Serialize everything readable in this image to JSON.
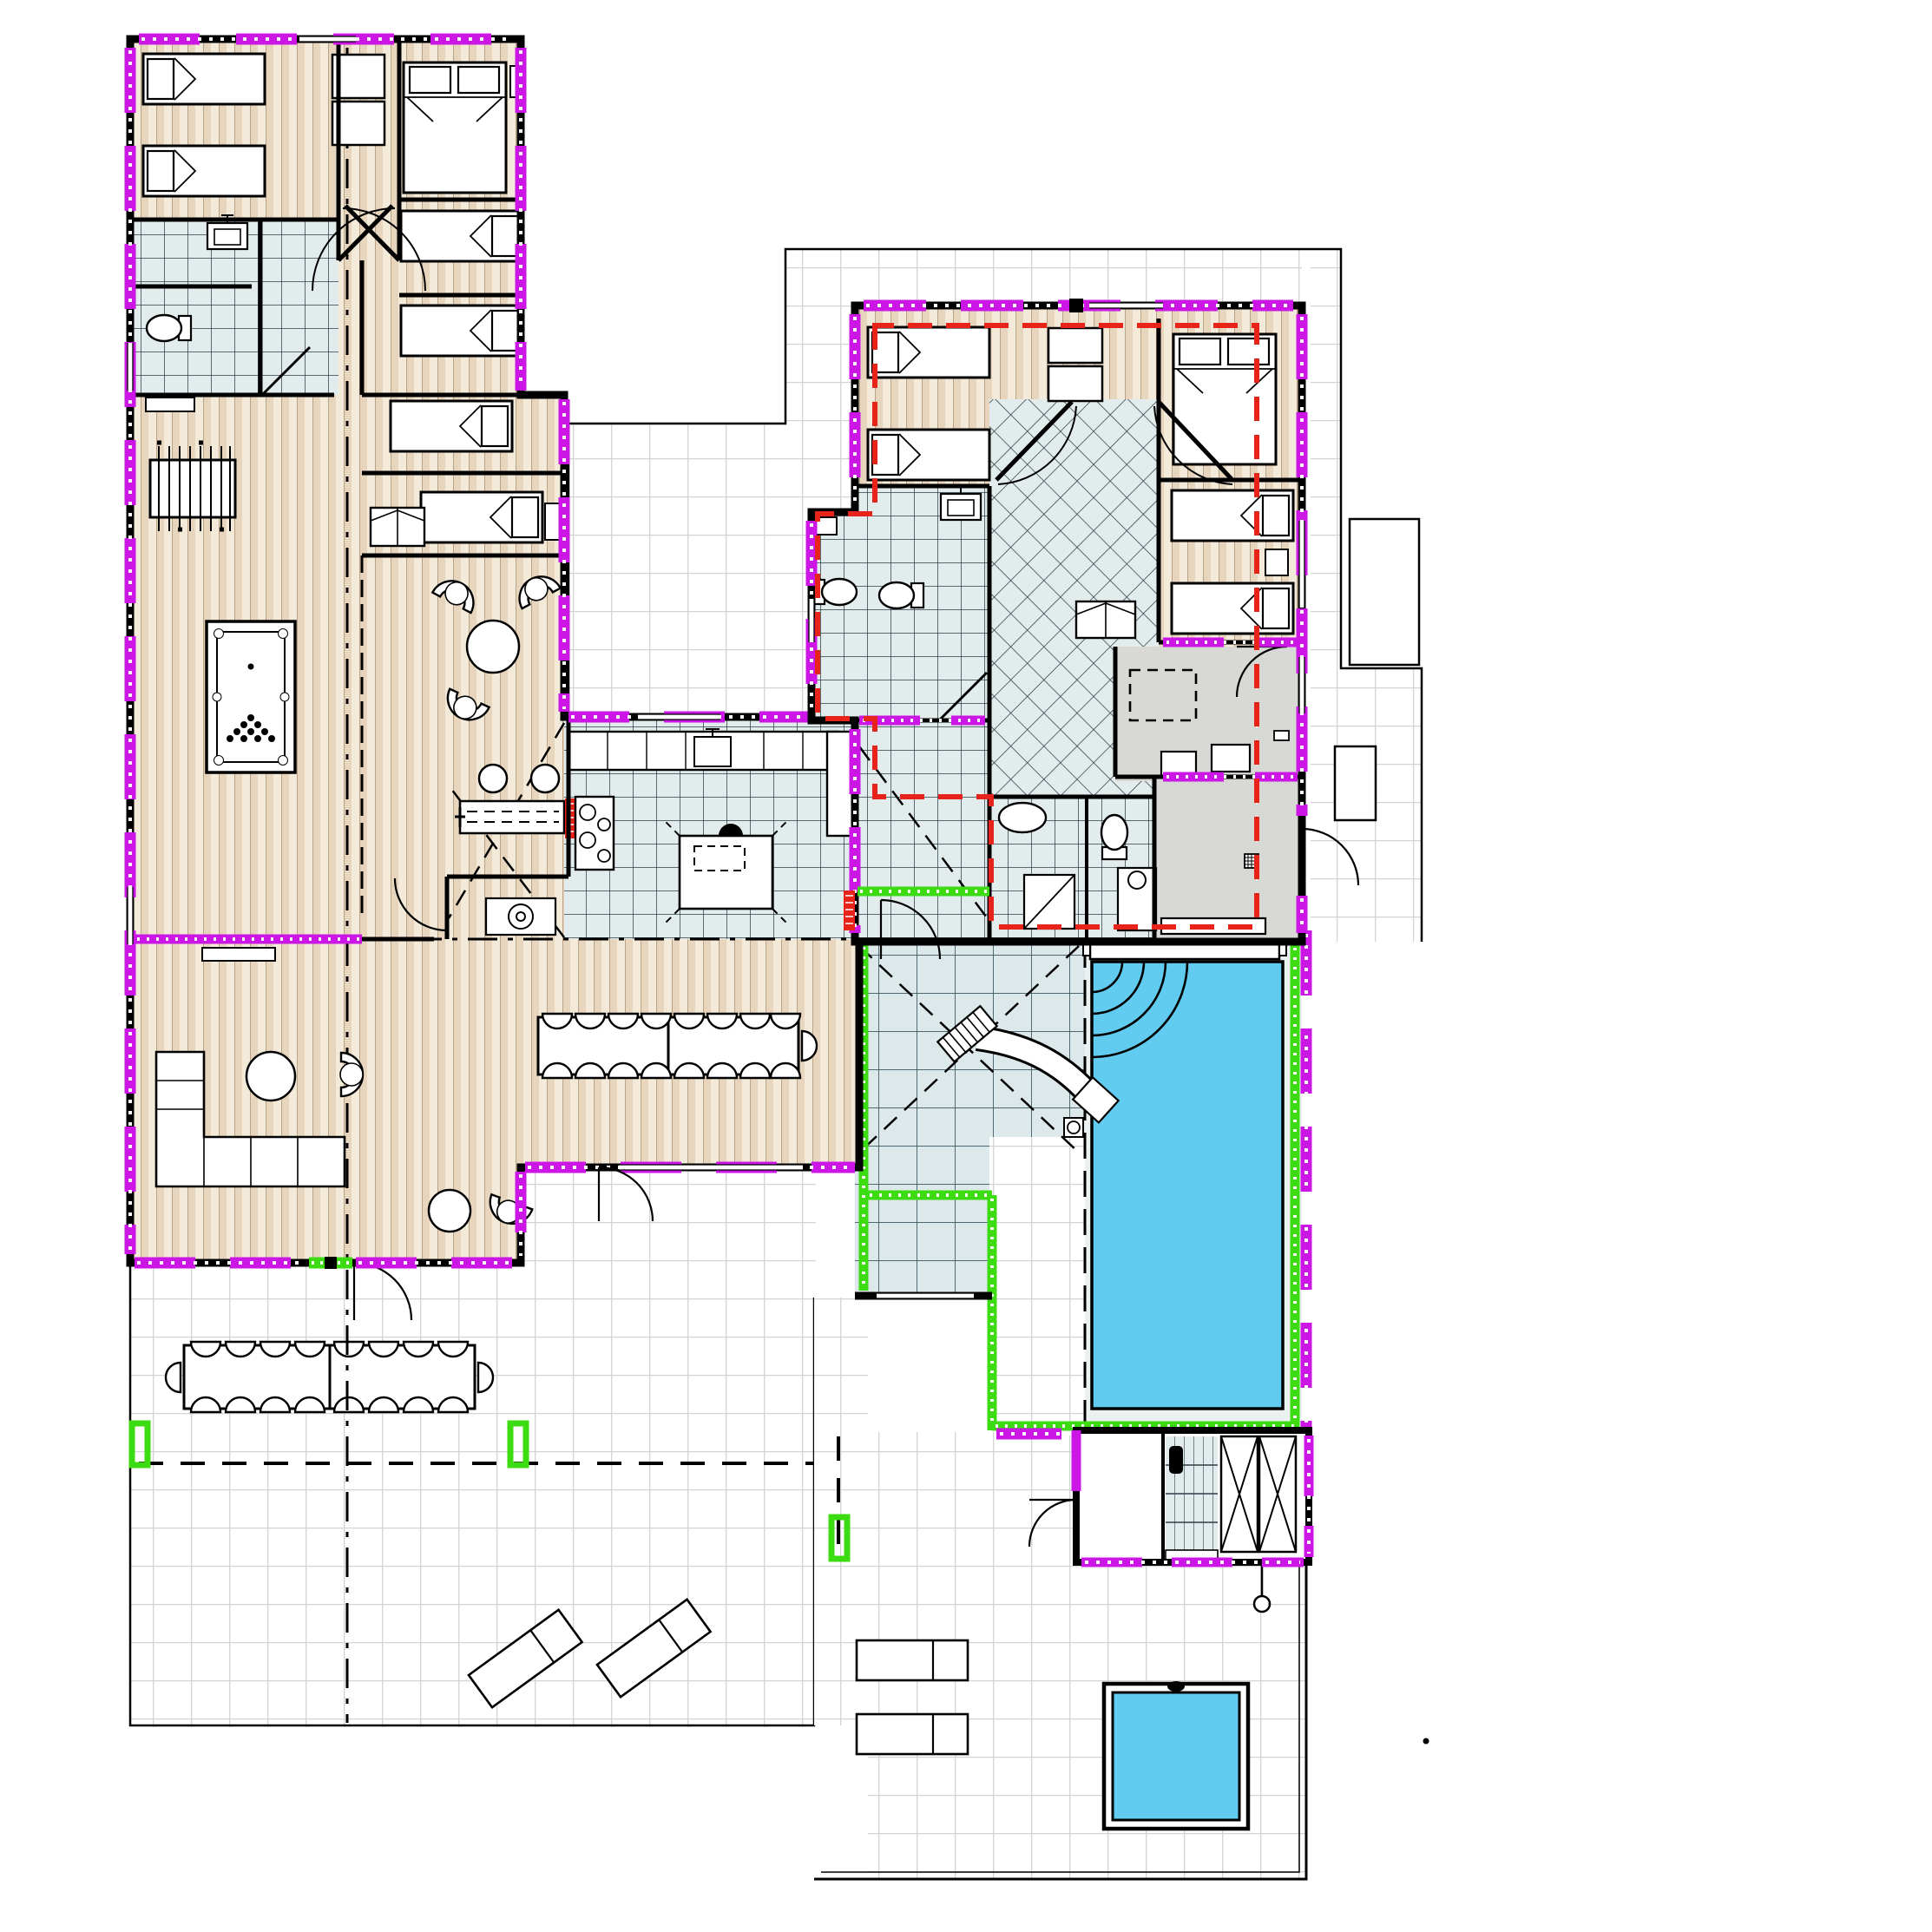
{
  "document": {
    "kind": "architectural-floor-plan",
    "subject": "holiday-villa ground floor with two bedroom wings, shared living core, pool yard and terraces",
    "visible_text": [],
    "scale_note": "no text, dimensions or labels are printed on the drawing"
  },
  "palette": {
    "paper": "#ffffff",
    "wall": "#000000",
    "magenta": "#cb16e6",
    "green": "#3ddc12",
    "red": "#e8231a",
    "water": "#62cbf0",
    "wood_base": "#f4ead9",
    "wood_stripe": "#e7d5bd",
    "wood_line": "#a2876a",
    "tile_bg": "#e2ecec",
    "tile_line": "#2c3e46",
    "tile_big_bg": "#dde8ea",
    "tile_big_line": "#3a5560",
    "terrace_line": "#d4d4d4",
    "gray_floor": "#d8d8d5",
    "deck": "#ebf0f1"
  },
  "legend": {
    "magenta_band": "insulated / new exterior wall marker with window segments",
    "green_band": "pool-yard enclosure marker",
    "red_dashed": "unit / fire compartment boundary around right wing",
    "red_box": "technical equipment marker",
    "dash_dot": "section and roof-ridge lines",
    "dashed_rect_outline": "pergola / canopy overhead outline"
  },
  "rooms": {
    "left_wing": [
      "twin-bedroom",
      "double-bedroom",
      "single-bedroom-1",
      "single-bedroom-2",
      "single-bedroom-3",
      "single-bedroom-4",
      "bathroom",
      "shower-wc",
      "hallway-with-closets"
    ],
    "core": [
      "games-area",
      "sitting-area",
      "kitchen",
      "pantry",
      "dining-room",
      "lounge"
    ],
    "right_wing": [
      "twin-bedroom",
      "double-bedroom",
      "single-bedroom-1",
      "single-bedroom-2",
      "family-bathroom",
      "separate-wc",
      "hallway-with-closets",
      "laundry",
      "bathroom",
      "shower-room",
      "entrance-hall"
    ],
    "outdoor": [
      "upper-terrace",
      "pool-yard",
      "covered-pool-terrace",
      "sauna-block",
      "lower-terrace-west",
      "lower-terrace-east"
    ]
  },
  "inventory": {
    "single_beds": 10,
    "double_beds": 2,
    "billiard_table": 1,
    "foosball_table": 1,
    "armchairs": 5,
    "indoor_dining_seats": 17,
    "outdoor_dining_seats": 18,
    "sun_loungers": 4,
    "swimming_pool": {
      "shape": "rectangular",
      "features": [
        "water-slide",
        "corner-steps",
        "skimmer",
        "bench"
      ]
    },
    "jacuzzi_plunge_pool": 1,
    "sauna_benches": 2,
    "kitchen": [
      "counter-with-sink",
      "cooktop-4-burners",
      "tall-cabinet",
      "island"
    ],
    "sanitary": {
      "toilets": 5,
      "sinks": 6,
      "showers": 4
    }
  }
}
